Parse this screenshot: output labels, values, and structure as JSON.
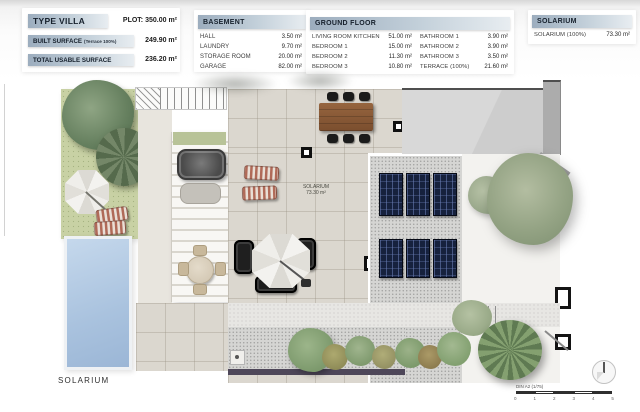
{
  "summary": {
    "title": "TYPE VILLA",
    "plot": "PLOT: 350.00 m²",
    "rows": [
      {
        "label": "BUILT SURFACE",
        "note": "(Terrace 100%)",
        "value": "249.90 m²"
      },
      {
        "label": "TOTAL USABLE SURFACE",
        "note": "",
        "value": "236.20 m²"
      }
    ]
  },
  "basement": {
    "title": "BASEMENT",
    "rows": [
      {
        "label": "HALL",
        "value": "3.50 m²"
      },
      {
        "label": "LAUNDRY",
        "value": "9.70 m²"
      },
      {
        "label": "STORAGE ROOM",
        "value": "20.00 m²"
      },
      {
        "label": "GARAGE",
        "value": "82.00 m²"
      }
    ]
  },
  "ground_floor": {
    "title": "GROUND FLOOR",
    "left_rows": [
      {
        "label": "LIVING ROOM KITCHEN",
        "value": "51.00 m²"
      },
      {
        "label": "BEDROOM 1",
        "value": "15.00 m²"
      },
      {
        "label": "BEDROOM 2",
        "value": "11.30 m²"
      },
      {
        "label": "BEDROOM 3",
        "value": "10.80 m²"
      }
    ],
    "right_rows": [
      {
        "label": "BATHROOM 1",
        "value": "3.90 m²"
      },
      {
        "label": "BATHROOM 2",
        "value": "3.90 m²"
      },
      {
        "label": "BATHROOM 3",
        "value": "3.50 m²"
      },
      {
        "label": "TERRACE (100%)",
        "value": "21.60 m²"
      }
    ]
  },
  "solarium_table": {
    "title": "SOLARIUM",
    "rows": [
      {
        "label": "SOLARIUM (100%)",
        "value": "73.30 m²"
      }
    ]
  },
  "plan": {
    "area_label_line1": "SOLARIUM",
    "area_label_line2": "73.30 m²",
    "floor_label": "SOLARIUM",
    "scale_text": "DIN A2 (1/75)",
    "scale_ticks": [
      "0",
      "1",
      "2",
      "3",
      "4",
      "5"
    ]
  },
  "colors": {
    "accent_bar_left": "#9cadbe",
    "accent_bar_right": "#e8edf1",
    "pool": "#a9c2de",
    "grass": "#c8d1a4",
    "solar_panel": "#16213d",
    "tile": "#dbd7cf",
    "wall_strip": "#4e4759"
  }
}
